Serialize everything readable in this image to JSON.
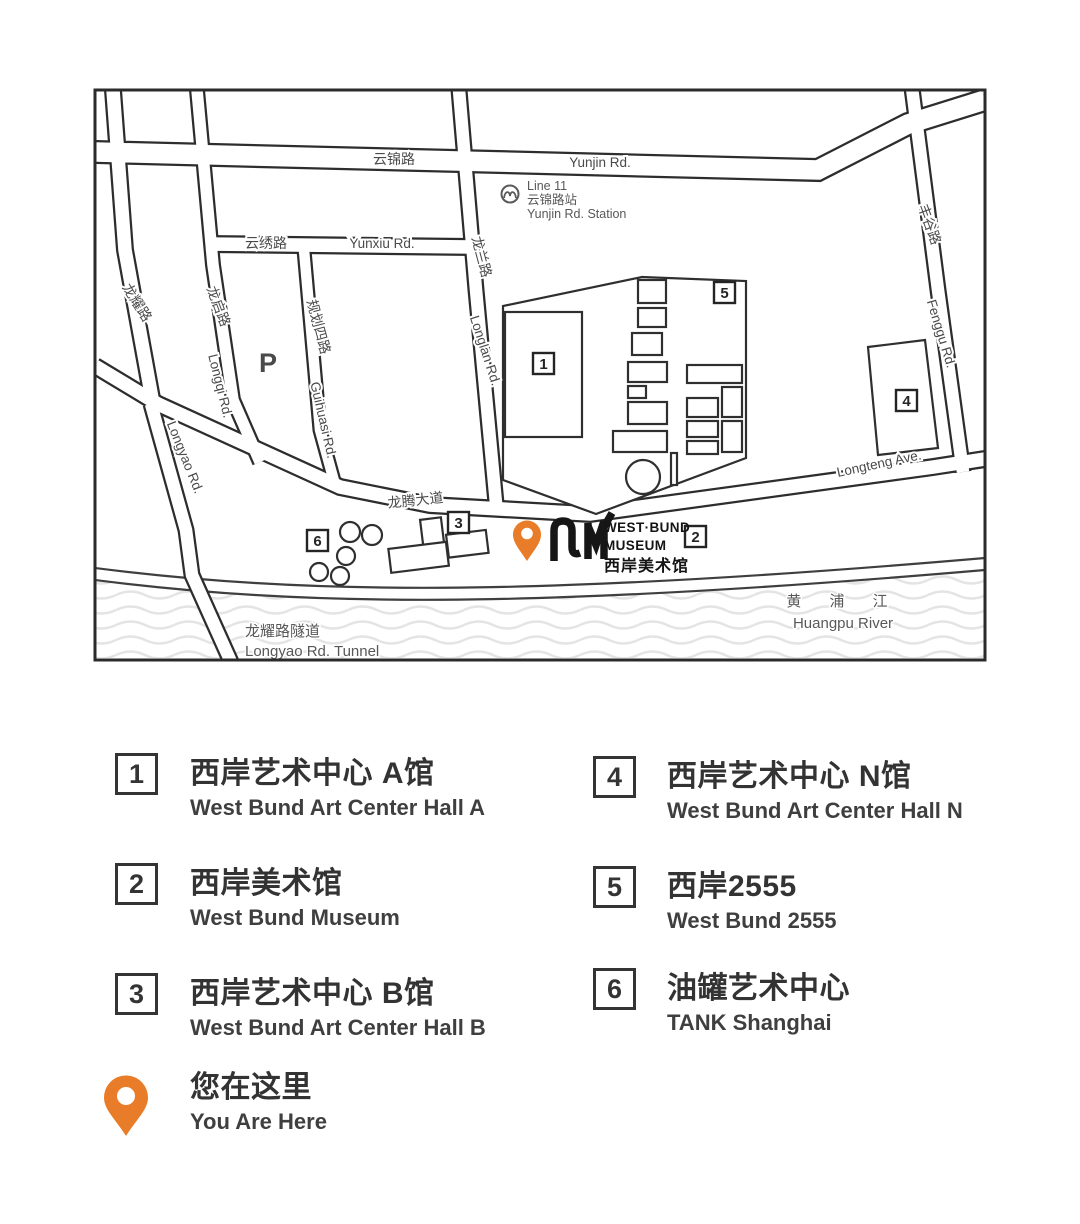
{
  "map": {
    "roads": {
      "yunjin_zh": "云锦路",
      "yunjin_en": "Yunjin Rd.",
      "yunxiu_zh": "云绣路",
      "yunxiu_en": "Yunxiu Rd.",
      "longlan_zh": "龙兰路",
      "longlan_en": "Longlan Rd.",
      "longyao_zh": "龙耀路",
      "longyao_en": "Longyao Rd.",
      "longqi_zh": "龙启路",
      "longqi_en": "Longqi Rd.",
      "guihuasi_zh": "规划四路",
      "guihuasi_en": "Guihuasi Rd.",
      "fenggu_zh": "丰谷路",
      "fenggu_en": "Fenggu Rd.",
      "longteng_zh": "龙腾大道",
      "longteng_en": "Longteng Ave.",
      "tunnel_zh": "龙耀路隧道",
      "tunnel_en": "Longyao Rd. Tunnel"
    },
    "metro": {
      "line": "Line 11",
      "station_zh": "云锦路站",
      "station_en": "Yunjin Rd. Station"
    },
    "river": {
      "zh": "黄 浦 江",
      "en": "Huangpu River"
    },
    "parking": "P",
    "logo": {
      "line1": "WEST·BUND",
      "line2": "MUSEUM",
      "line3": "西岸美术馆"
    },
    "markers": {
      "m1": "1",
      "m2": "2",
      "m3": "3",
      "m4": "4",
      "m5": "5",
      "m6": "6"
    }
  },
  "legend": {
    "items": [
      {
        "num": "1",
        "zh": "西岸艺术中心 A馆",
        "en": "West Bund Art Center Hall A"
      },
      {
        "num": "2",
        "zh": "西岸美术馆",
        "en": "West Bund Museum"
      },
      {
        "num": "3",
        "zh": "西岸艺术中心 B馆",
        "en": "West Bund Art Center Hall B"
      },
      {
        "num": "4",
        "zh": "西岸艺术中心 N馆",
        "en": "West Bund Art Center Hall N"
      },
      {
        "num": "5",
        "zh": "西岸2555",
        "en": "West Bund 2555"
      },
      {
        "num": "6",
        "zh": "油罐艺术中心",
        "en": "TANK Shanghai"
      }
    ],
    "you_are_here": {
      "zh": "您在这里",
      "en": "You Are Here"
    }
  },
  "colors": {
    "pin_orange": "#E87C28",
    "line_dark": "#2d2d2d",
    "label_gray": "#4a4a4a"
  }
}
